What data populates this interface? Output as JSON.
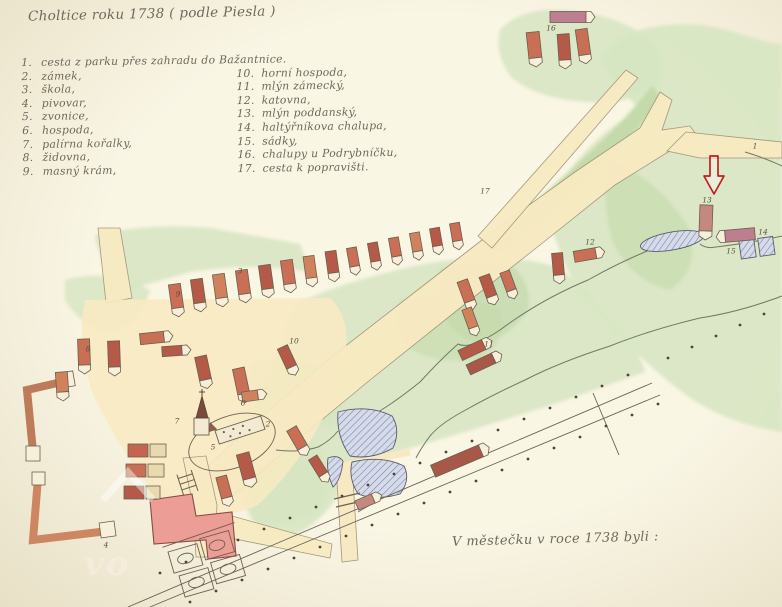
{
  "title": "Choltice roku 1738 ( podle Piesla )",
  "legend": {
    "items": [
      {
        "num": "1.",
        "label": "cesta z parku přes zahradu do Bažantnice."
      },
      {
        "num": "2.",
        "label": "zámek,"
      },
      {
        "num": "3.",
        "label": "škola,"
      },
      {
        "num": "4.",
        "label": "pivovar,"
      },
      {
        "num": "5.",
        "label": "zvonice,"
      },
      {
        "num": "6.",
        "label": "hospoda,"
      },
      {
        "num": "7.",
        "label": "palírna kořalky,"
      },
      {
        "num": "8.",
        "label": "židovna,"
      },
      {
        "num": "9.",
        "label": "masný krám,"
      },
      {
        "num": "10.",
        "label": "horní hospoda,"
      },
      {
        "num": "11.",
        "label": "mlýn zámecký,"
      },
      {
        "num": "12.",
        "label": "katovna,"
      },
      {
        "num": "13.",
        "label": "mlýn poddanský,"
      },
      {
        "num": "14.",
        "label": "haltýřníkova chalupa,"
      },
      {
        "num": "15.",
        "label": "sádky,"
      },
      {
        "num": "16.",
        "label": "chalupy u Podrybníčku,"
      },
      {
        "num": "17.",
        "label": "cesta k popravišti."
      }
    ]
  },
  "caption": "V městečku v roce 1738 byli :",
  "watermark": "vo",
  "map": {
    "labels": [
      "1",
      "2",
      "3",
      "4",
      "5",
      "6",
      "7",
      "8",
      "9",
      "10",
      "11",
      "12",
      "13",
      "14",
      "15",
      "16",
      "17"
    ],
    "annotation": {
      "icon": "red-arrow",
      "color": "#c41e1e"
    }
  },
  "colors": {
    "paper": "#f3eed9",
    "green": "#d7e5c2",
    "green_dark": "#c3d9a9",
    "path": "#f7eac2",
    "building": "#c96f55",
    "roof_dark": "#b55a48",
    "pink_building": "#ec9e96",
    "pond": "#d6dbe9",
    "ink": "#6b6254",
    "arrow_red": "#c41e1e"
  }
}
